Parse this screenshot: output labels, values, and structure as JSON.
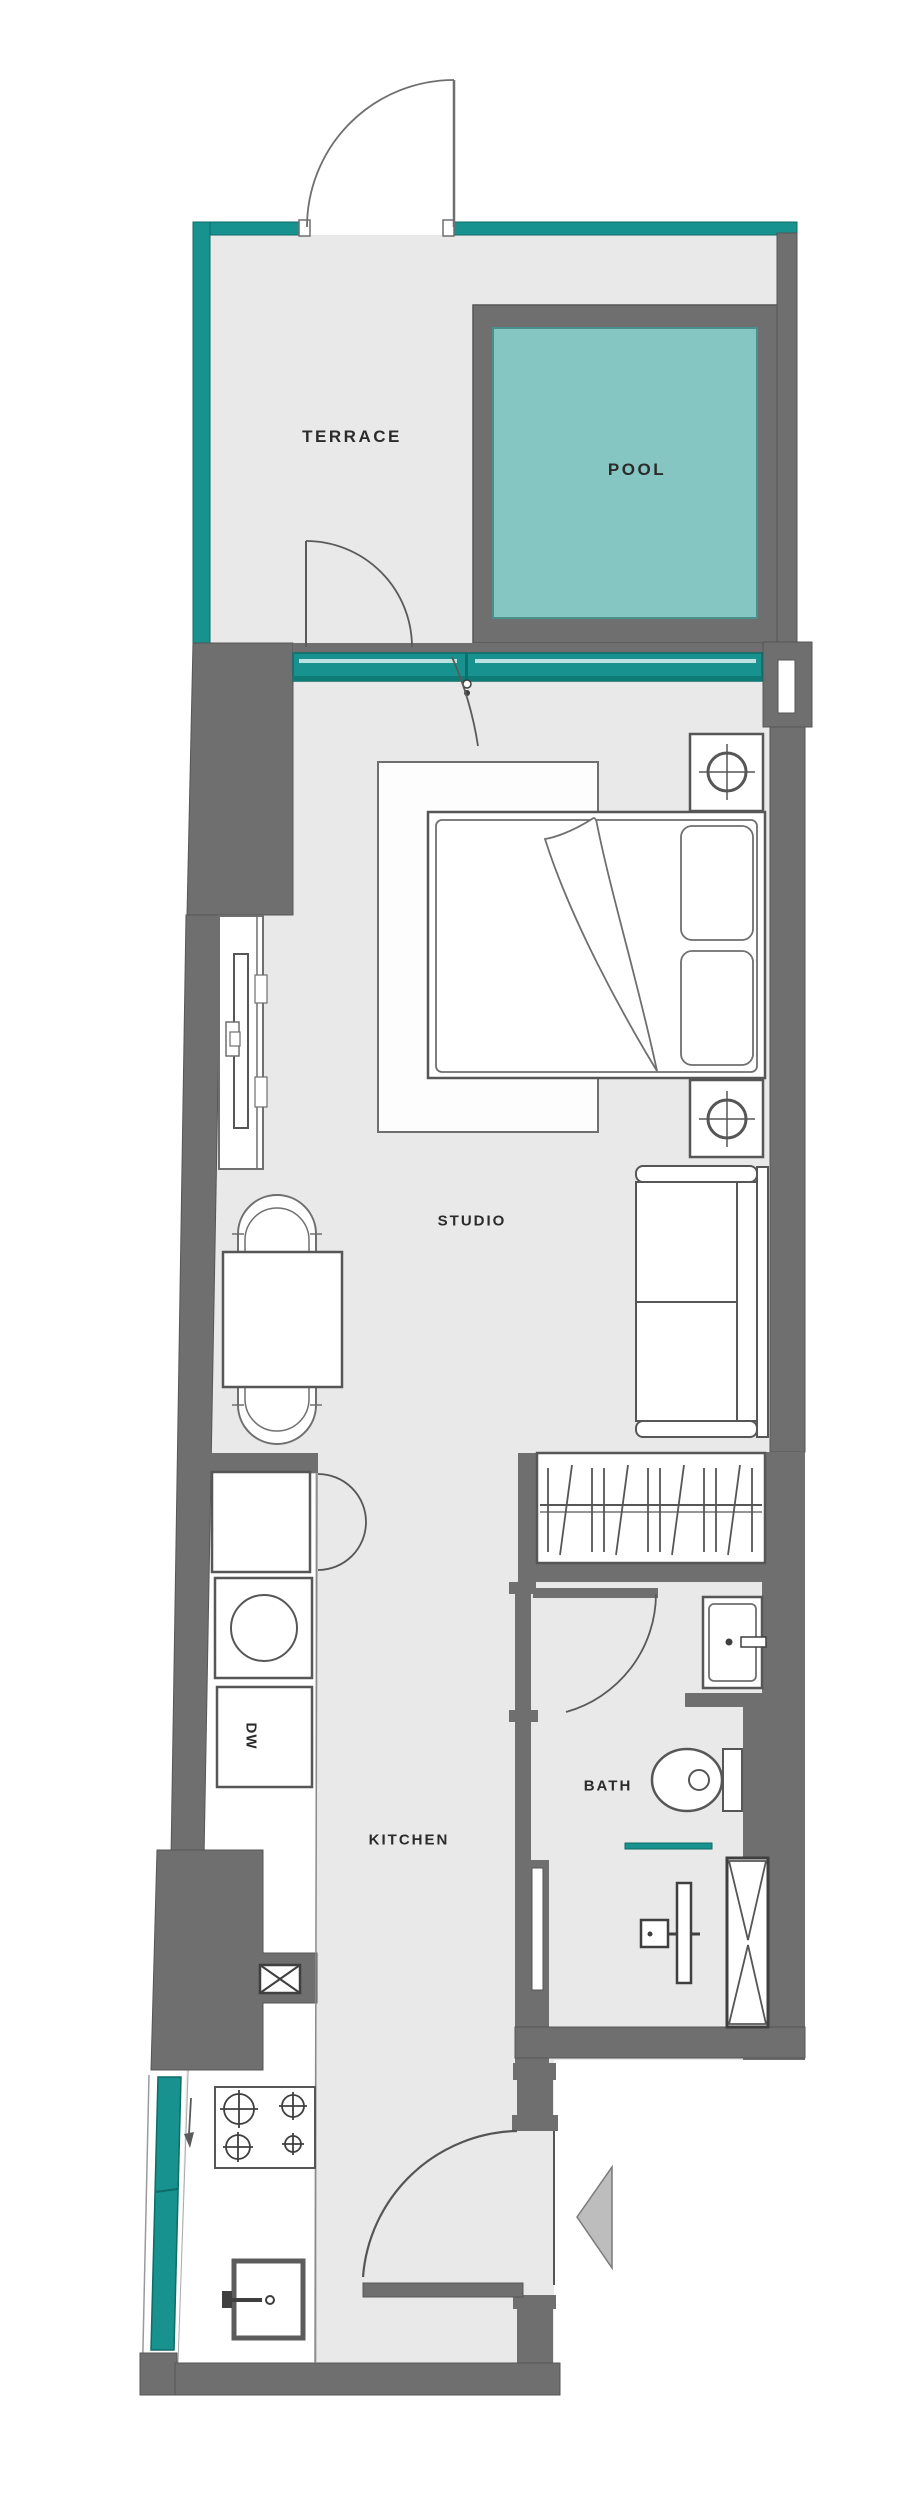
{
  "title": "Studio apartment floor plan",
  "rooms": {
    "terrace": "TERRACE",
    "pool": "POOL",
    "studio": "STUDIO",
    "bath": "BATH",
    "kitchen": "KITCHEN"
  },
  "appliances": {
    "dishwasher": "DW"
  },
  "colors": {
    "wall_gray": "#6f6f6f",
    "accent_teal": "#17928e",
    "pool_water": "#85c6c2",
    "floor_gray": "#e9e9e9",
    "line_dark": "#565656",
    "background": "#ffffff",
    "arrow_fill": "#bdbdbd"
  }
}
